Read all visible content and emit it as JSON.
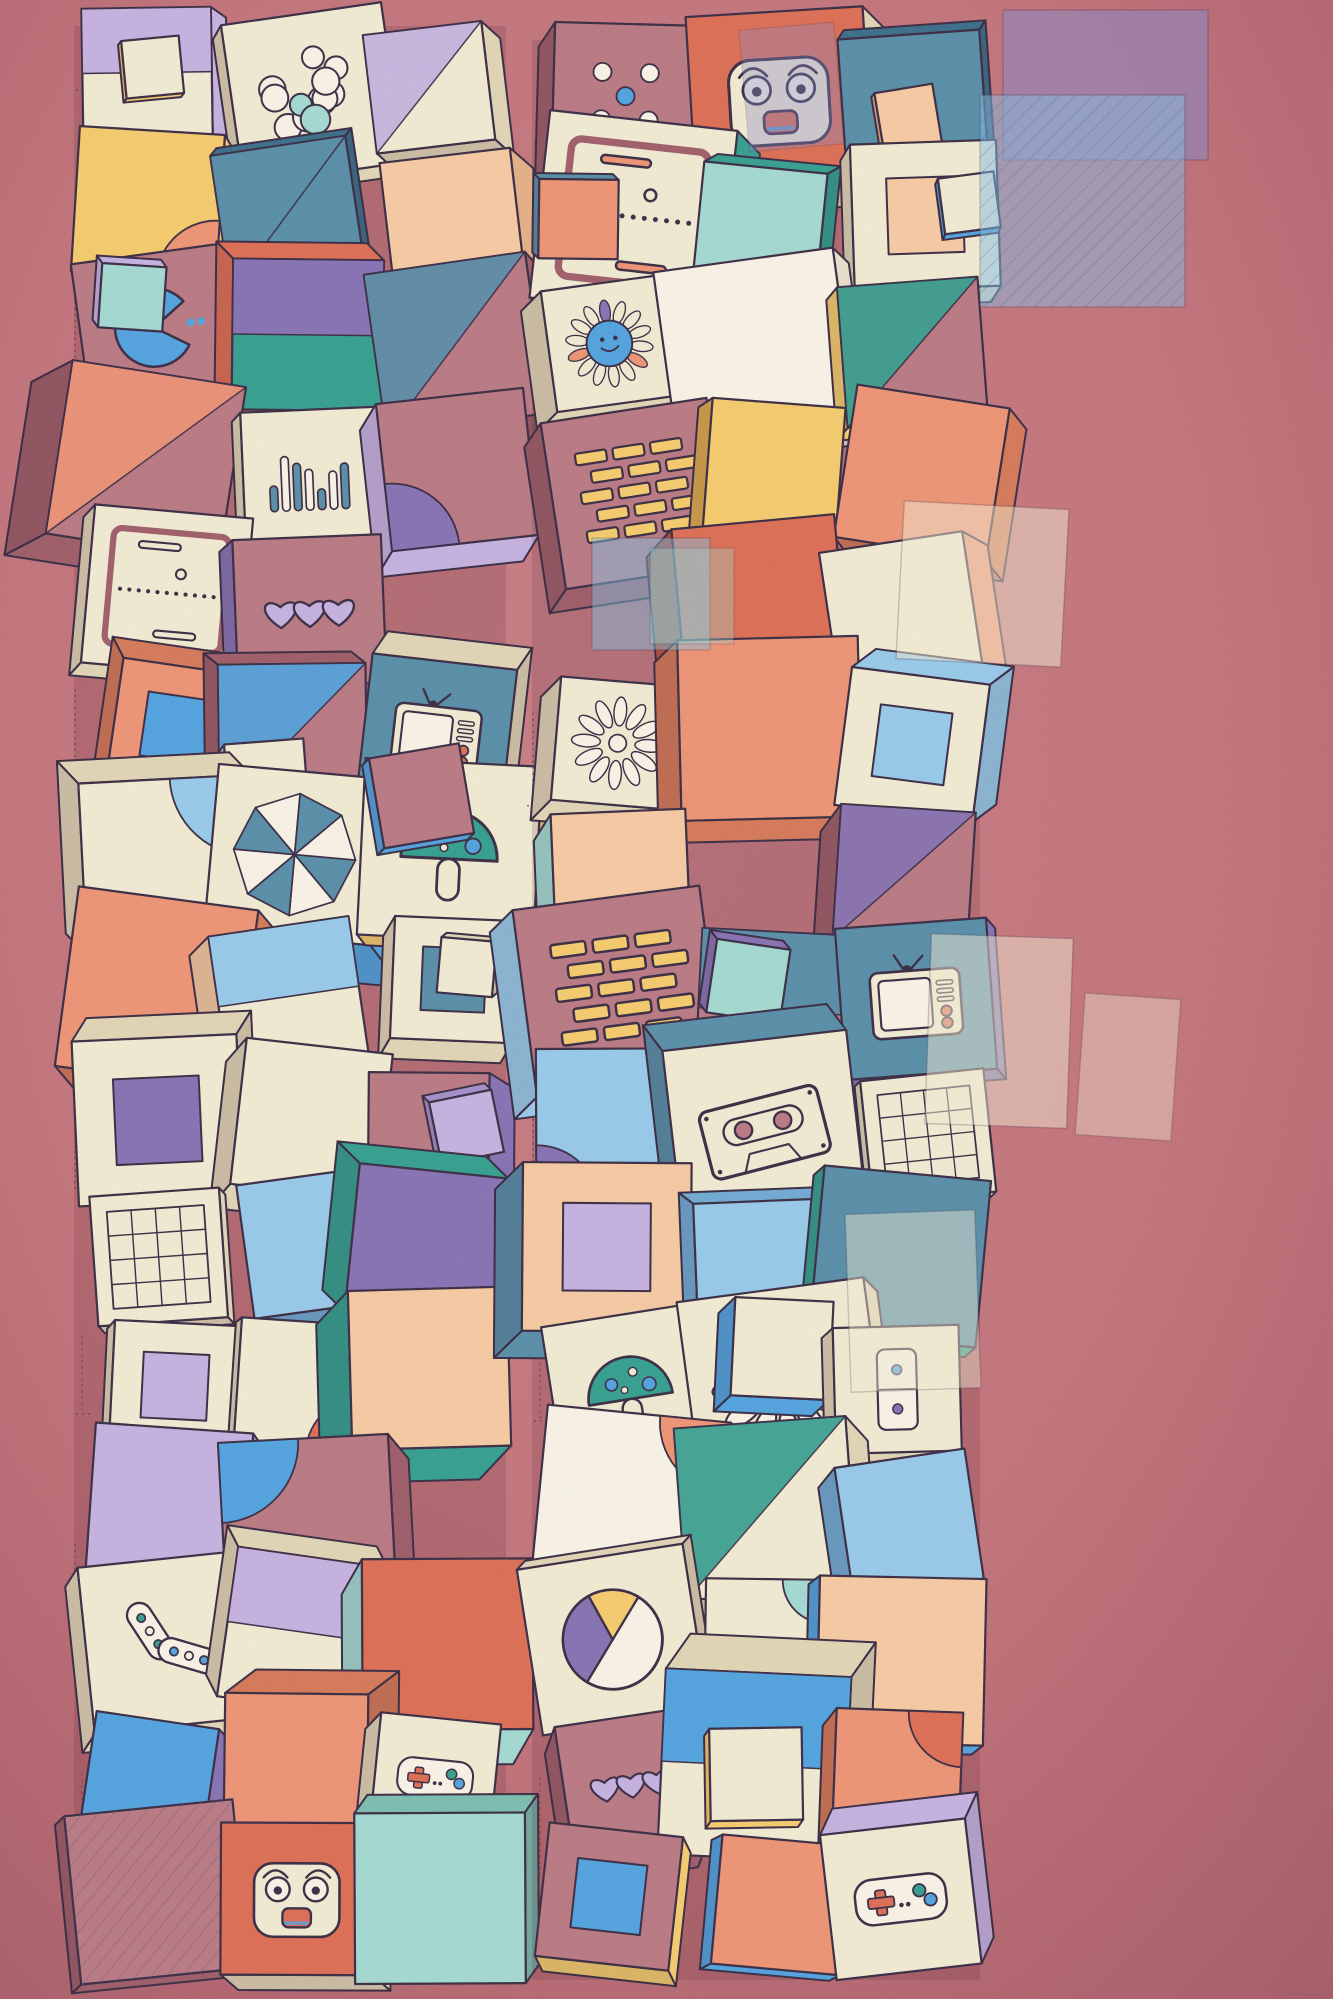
{
  "canvas": {
    "width": 1333,
    "height": 1999
  },
  "background": {
    "base": "#c6787f",
    "light": "#cb838a",
    "edge": "#a95f6b",
    "ink": "#41334a",
    "sketch": "#7c4350",
    "shadow": "rgba(90,38,52,0.16)"
  },
  "palette": {
    "cream": "#f4edd6",
    "white": "#faf5e8",
    "mauve": "#bd7e88",
    "mauve_deep": "#a4636f",
    "salmon": "#f0987a",
    "peach": "#f8cda6",
    "coral": "#e0735a",
    "yellow": "#f7ce72",
    "blue": "#58a7e2",
    "sky": "#9ccdec",
    "steel": "#5e92ac",
    "steel_deep": "#3f7590",
    "teal": "#3ba393",
    "mint": "#a7dcd4",
    "lavender": "#c9b5e3",
    "purple": "#8b77b6"
  },
  "shades": {
    "cream": "#e4d8b9",
    "white": "#eae2cc",
    "mauve": "#a2626e",
    "mauve_deep": "#8a4f5b",
    "salmon": "#d87e5e",
    "peach": "#e7b38b",
    "coral": "#c05a44",
    "yellow": "#dfae52",
    "blue": "#3c83c4",
    "sky": "#76aed6",
    "steel": "#42738e",
    "steel_deep": "#2f5d75",
    "teal": "#2f8577",
    "mint": "#82c0b4",
    "lavender": "#a992cc",
    "purple": "#6f5da0"
  },
  "accents": [
    "blue",
    "teal",
    "lavender",
    "purple",
    "yellow",
    "salmon",
    "mint",
    "steel",
    "peach",
    "coral",
    "sky"
  ],
  "face_weights": {
    "cream": 46,
    "white": 4,
    "mauve": 20,
    "salmon": 6,
    "peach": 4,
    "blue": 4,
    "steel": 3,
    "teal": 3,
    "yellow": 3,
    "lavender": 2,
    "purple": 2,
    "mint": 3,
    "sky": 2,
    "coral": 2
  },
  "tile": {
    "rotation_max": 9,
    "size_min": 0.82,
    "size_max": 1.3,
    "depth_min": 12,
    "depth_max": 40,
    "skip_chance": 0.06,
    "motif_chance_cream": 0.52,
    "motif_chance_mauve": 0.46,
    "deco_chance": 0.3,
    "stack_chance": 0.1
  },
  "columns": [
    {
      "name": "left",
      "x": 90,
      "y": 16,
      "width": 422,
      "height": 1950,
      "tiles_across": 3,
      "rows": 15
    },
    {
      "name": "right",
      "x": 548,
      "y": 30,
      "width": 438,
      "height": 1940,
      "tiles_across": 3,
      "rows": 15
    }
  ],
  "motifs_on_cream": [
    "pong",
    "smiley-flower",
    "daisy",
    "balls",
    "gamepad",
    "eq-bars",
    "arcs",
    "pills",
    "grid",
    "wheel",
    "skull",
    "tv",
    "cassette",
    "domino",
    "pie-chart",
    "gameboy",
    "mushroom",
    "vinyl",
    "robot-face",
    "pinwheel"
  ],
  "motifs_on_mauve": [
    "hearts",
    "dice",
    "bricks",
    "citrus",
    "pacman",
    "skull",
    "phone",
    "vinyl",
    "checkerboard",
    "pinwheel",
    "mushroom",
    "arcs"
  ],
  "overlays": [
    {
      "x": 1003,
      "y": 10,
      "w": 205,
      "h": 150,
      "rot": 0,
      "color": "#8d8fc9",
      "opacity": 0.55,
      "hatch": false
    },
    {
      "x": 980,
      "y": 95,
      "w": 205,
      "h": 212,
      "rot": 0,
      "color": "#8ac2e8",
      "opacity": 0.5,
      "hatch": true
    },
    {
      "x": 744,
      "y": 26,
      "w": 95,
      "h": 122,
      "rot": -5,
      "color": "#8d8fc9",
      "opacity": 0.35,
      "hatch": false
    },
    {
      "x": 592,
      "y": 538,
      "w": 118,
      "h": 112,
      "rot": 0,
      "color": "#86c8e8",
      "opacity": 0.45,
      "hatch": false
    },
    {
      "x": 650,
      "y": 548,
      "w": 84,
      "h": 96,
      "rot": 0,
      "color": "#a7dcd4",
      "opacity": 0.35,
      "hatch": false
    },
    {
      "x": 900,
      "y": 505,
      "w": 165,
      "h": 158,
      "rot": 3,
      "color": "#f4edd6",
      "opacity": 0.5,
      "hatch": false
    },
    {
      "x": 928,
      "y": 936,
      "w": 142,
      "h": 190,
      "rot": 2,
      "color": "#f4edd6",
      "opacity": 0.5,
      "hatch": false
    },
    {
      "x": 848,
      "y": 1212,
      "w": 130,
      "h": 178,
      "rot": -2,
      "color": "#f4edd6",
      "opacity": 0.45,
      "hatch": false
    },
    {
      "x": 1080,
      "y": 996,
      "w": 96,
      "h": 142,
      "rot": 4,
      "color": "#f4edd6",
      "opacity": 0.4,
      "hatch": false
    }
  ],
  "seed": 1337
}
